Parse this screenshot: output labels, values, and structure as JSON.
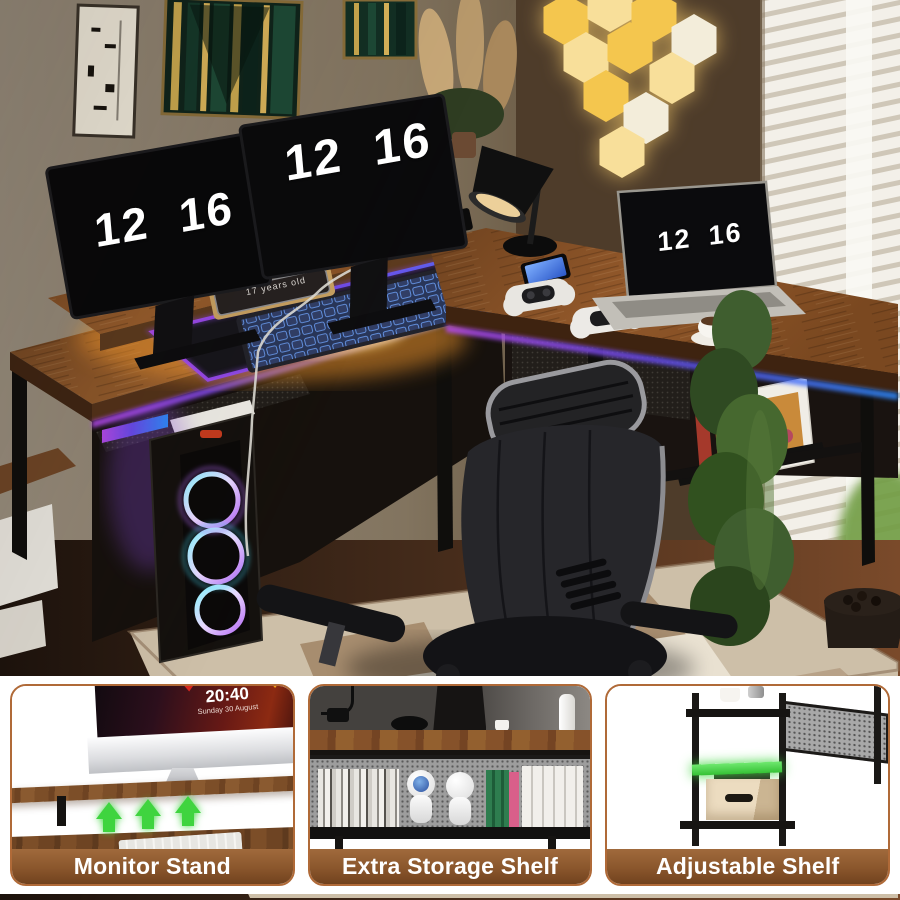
{
  "product_scene": {
    "left_monitor_time": "12 16",
    "right_monitor_time": "12 16",
    "laptop_time": "12 16",
    "desk_plaque_text": "17 years old"
  },
  "callouts": [
    {
      "label": "Monitor Stand",
      "screen_time": "20:40",
      "screen_date": "Sunday 30 August"
    },
    {
      "label": "Extra Storage Shelf"
    },
    {
      "label": "Adjustable Shelf"
    }
  ],
  "colors": {
    "callout_border": "#b06a38",
    "label_bar_brown": "#8a562c",
    "accent_green": "#3fd43f",
    "desk_wood": "#7c4e28",
    "rgb_purple": "#8b46e8",
    "rgb_blue": "#2f6bff",
    "led_warm_glow": "#ffb13c",
    "hex_light_gold": "#f4c64e"
  }
}
